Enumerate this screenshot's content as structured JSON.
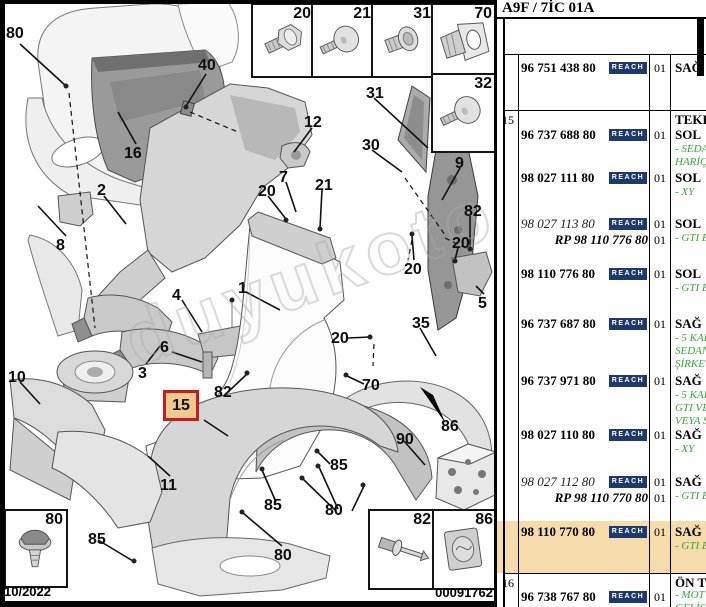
{
  "diagram": {
    "watermark": "duyukoto.com",
    "footer_date": "10/2022",
    "footer_code": "00091762",
    "highlight_label": "15",
    "boxes": {
      "b20": "20",
      "b21": "21",
      "b31": "31",
      "b70": "70",
      "b32": "32",
      "b80": "80",
      "b82": "82",
      "b86": "86"
    },
    "labels": [
      {
        "t": "80",
        "x": 6,
        "y": 26
      },
      {
        "t": "40",
        "x": 198,
        "y": 58
      },
      {
        "t": "16",
        "x": 124,
        "y": 146
      },
      {
        "t": "2",
        "x": 97,
        "y": 183
      },
      {
        "t": "8",
        "x": 56,
        "y": 238
      },
      {
        "t": "10",
        "x": 8,
        "y": 370
      },
      {
        "t": "3",
        "x": 138,
        "y": 366
      },
      {
        "t": "4",
        "x": 172,
        "y": 288
      },
      {
        "t": "6",
        "x": 160,
        "y": 340
      },
      {
        "t": "1",
        "x": 238,
        "y": 281
      },
      {
        "t": "12",
        "x": 304,
        "y": 115
      },
      {
        "t": "31",
        "x": 366,
        "y": 86
      },
      {
        "t": "30",
        "x": 362,
        "y": 138
      },
      {
        "t": "9",
        "x": 455,
        "y": 156
      },
      {
        "t": "7",
        "x": 279,
        "y": 170
      },
      {
        "t": "21",
        "x": 315,
        "y": 178
      },
      {
        "t": "20",
        "x": 258,
        "y": 184
      },
      {
        "t": "82",
        "x": 464,
        "y": 204
      },
      {
        "t": "20",
        "x": 452,
        "y": 236
      },
      {
        "t": "20",
        "x": 404,
        "y": 262
      },
      {
        "t": "5",
        "x": 478,
        "y": 296
      },
      {
        "t": "35",
        "x": 412,
        "y": 316
      },
      {
        "t": "20",
        "x": 331,
        "y": 331
      },
      {
        "t": "70",
        "x": 362,
        "y": 378
      },
      {
        "t": "86",
        "x": 441,
        "y": 419
      },
      {
        "t": "82",
        "x": 214,
        "y": 385
      },
      {
        "t": "11",
        "x": 160,
        "y": 478
      },
      {
        "t": "90",
        "x": 396,
        "y": 432
      },
      {
        "t": "85",
        "x": 330,
        "y": 458
      },
      {
        "t": "85",
        "x": 264,
        "y": 498
      },
      {
        "t": "80",
        "x": 325,
        "y": 503
      },
      {
        "t": "80",
        "x": 274,
        "y": 548
      },
      {
        "t": "85",
        "x": 88,
        "y": 532
      }
    ]
  },
  "table": {
    "title": "A9F / 7İC 01A",
    "reach": "REACH",
    "g15": {
      "ref": "15",
      "head": "TEKER"
    },
    "g16": {
      "ref": "16",
      "head": "ÖN TE"
    },
    "rows": [
      {
        "part": "96 751 438 80",
        "qty": "01",
        "side": "SAĞ",
        "notes": []
      },
      {
        "part": "96 737 688 80",
        "qty": "01",
        "side": "SOL",
        "notes": [
          "- SEDA",
          "HARİÇ"
        ]
      },
      {
        "part": "98 027 111 80",
        "qty": "01",
        "side": "SOL",
        "notes": [
          "- XY"
        ]
      },
      {
        "part": "98 027 113 80",
        "rp": "RP 98 110 776 80",
        "qty": "01",
        "qty2": "01",
        "side": "SOL",
        "notes": [
          "- GTI E"
        ]
      },
      {
        "part": "98 110 776 80",
        "qty": "01",
        "side": "SOL",
        "notes": [
          "- GTI E"
        ]
      },
      {
        "part": "96 737 687 80",
        "qty": "01",
        "side": "SAĞ",
        "notes": [
          "- 5 KAP",
          "SEDAN",
          "ŞİRKE"
        ]
      },
      {
        "part": "96 737 971 80",
        "qty": "01",
        "side": "SAĞ",
        "notes": [
          "- 5 KAP",
          "GTI VE",
          "VEYA S"
        ]
      },
      {
        "part": "98 027 110 80",
        "qty": "01",
        "side": "SAĞ",
        "notes": [
          "- XY"
        ]
      },
      {
        "part": "98 027 112 80",
        "rp": "RP 98 110 770 80",
        "qty": "01",
        "qty2": "01",
        "side": "SAĞ",
        "notes": [
          "- GTI E"
        ]
      },
      {
        "part": "98 110 770 80",
        "qty": "01",
        "side": "SAĞ",
        "notes": [
          "- GTI E"
        ]
      },
      {
        "part": "96 738 767 80",
        "qty": "01",
        "side": "",
        "notes": [
          "- MOT",
          "GELİŞ"
        ]
      }
    ]
  }
}
